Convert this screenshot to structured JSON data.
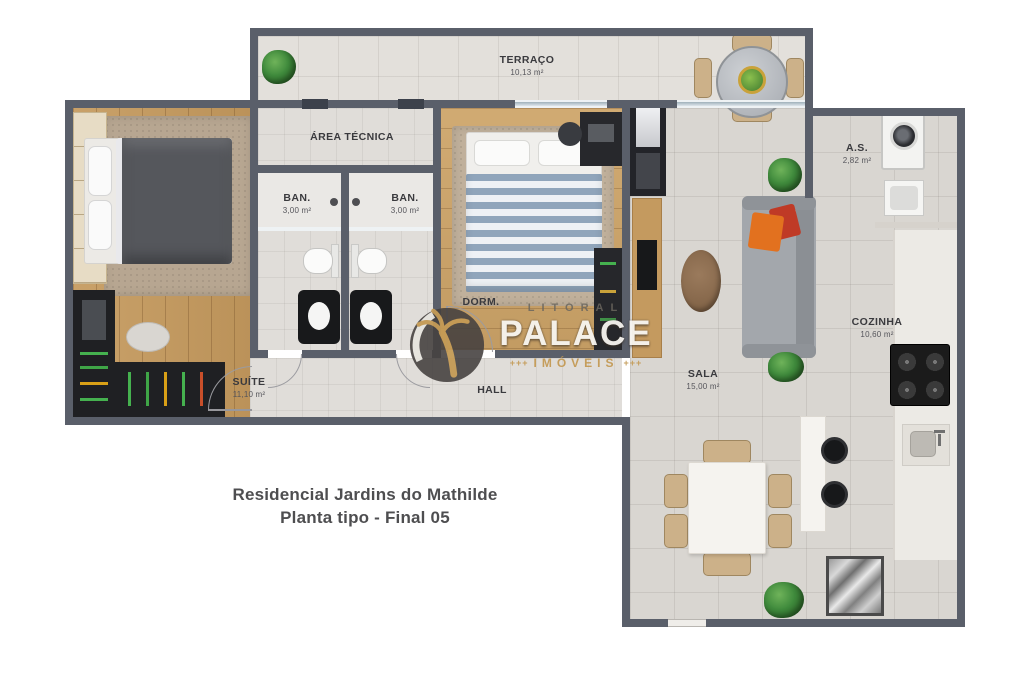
{
  "title": {
    "line1": "Residencial Jardins do Mathilde",
    "line2": "Planta tipo - Final 05"
  },
  "watermark": {
    "top": "LITORAL",
    "name": "PALACE",
    "sub": "IMÓVEIS",
    "marks_left": "+++",
    "marks_right": "+++"
  },
  "rooms": {
    "terraco": {
      "name": "TERRAÇO",
      "area": "10,13 m²"
    },
    "area_tecnica": {
      "name": "ÁREA TÉCNICA",
      "area": ""
    },
    "ban_1": {
      "name": "BAN.",
      "area": "3,00 m²"
    },
    "ban_2": {
      "name": "BAN.",
      "area": "3,00 m²"
    },
    "dorm": {
      "name": "DORM.",
      "area": ""
    },
    "suite": {
      "name": "SUÍTE",
      "area": "11,10 m²"
    },
    "hall": {
      "name": "HALL",
      "area": ""
    },
    "sala": {
      "name": "SALA",
      "area": "15,00 m²"
    },
    "as": {
      "name": "A.S.",
      "area": "2,82 m²"
    },
    "cozinha": {
      "name": "COZINHA",
      "area": "10,60 m²"
    }
  },
  "colors": {
    "wall": "#5a5f6a",
    "wood_floor": "#c59a5e",
    "tile_floor": "#d9d6d1",
    "watermark_gold": "#c49a55",
    "sofa_pillow_orange": "#e2711f",
    "sofa_pillow_red": "#bf3a26"
  }
}
